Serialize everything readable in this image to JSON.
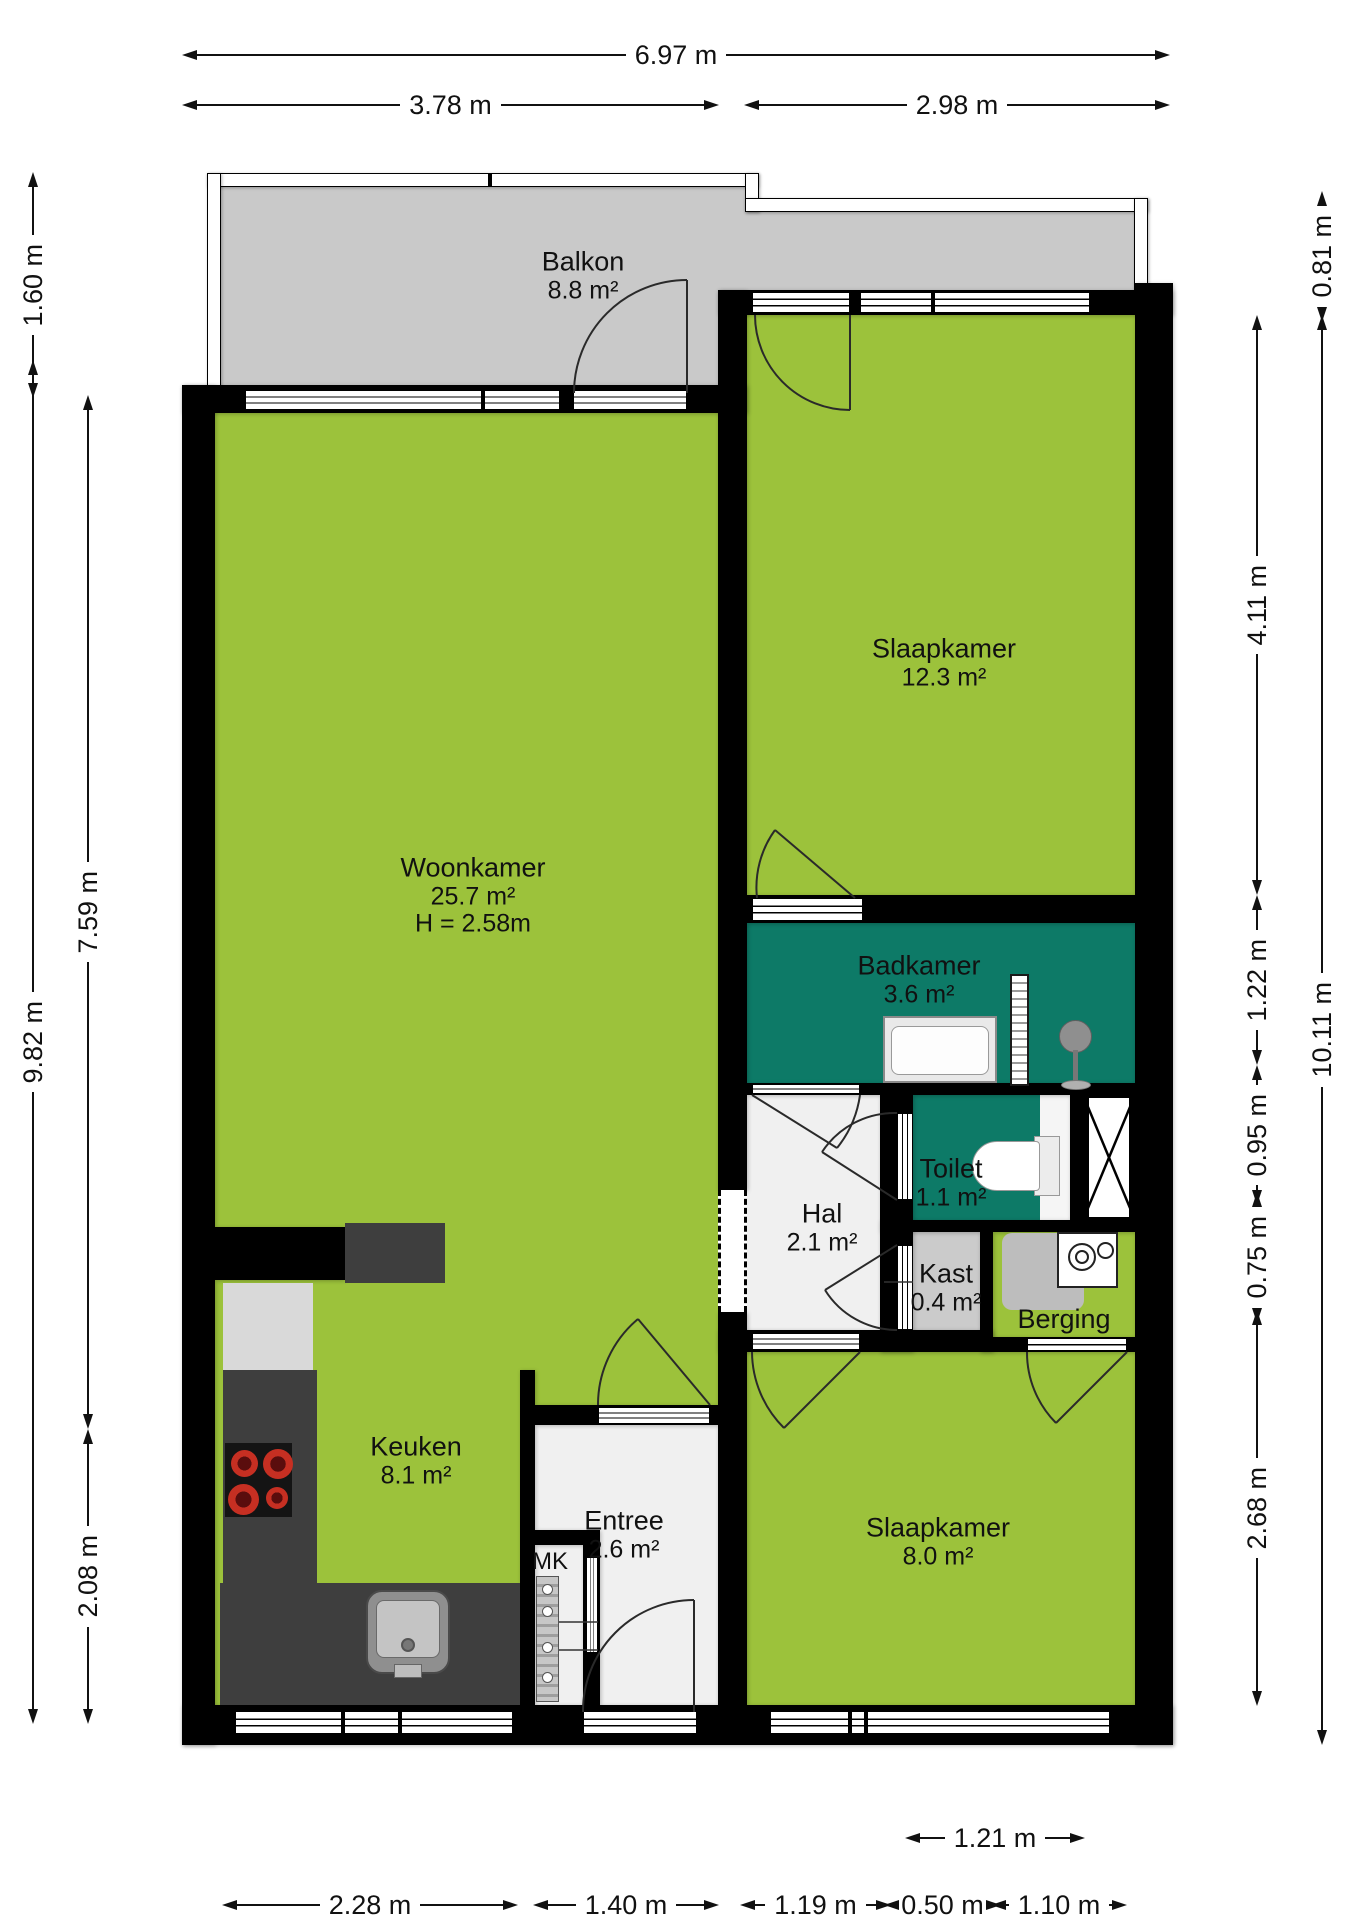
{
  "rooms": {
    "balkon": {
      "name": "Balkon",
      "area": "8.8 m²"
    },
    "woonkamer": {
      "name": "Woonkamer",
      "area": "25.7 m²",
      "ceiling_height": "H = 2.58m"
    },
    "slaapkamer_1": {
      "name": "Slaapkamer",
      "area": "12.3 m²"
    },
    "badkamer": {
      "name": "Badkamer",
      "area": "3.6 m²"
    },
    "toilet": {
      "name": "Toilet",
      "area": "1.1 m²"
    },
    "hal": {
      "name": "Hal",
      "area": "2.1 m²"
    },
    "kast": {
      "name": "Kast",
      "area": "0.4 m²"
    },
    "berging": {
      "name": "Berging"
    },
    "keuken": {
      "name": "Keuken",
      "area": "8.1 m²"
    },
    "entree": {
      "name": "Entree",
      "area": "2.6 m²"
    },
    "slaapkamer_2": {
      "name": "Slaapkamer",
      "area": "8.0 m²"
    },
    "meterkast": {
      "name": "MK"
    }
  },
  "dimensions": {
    "top_total": "6.97 m",
    "top_left": "3.78 m",
    "top_right": "2.98 m",
    "left_balcony": "1.60 m",
    "left_total": "9.82 m",
    "left_upper": "7.59 m",
    "left_lower": "2.08 m",
    "right_balcony": "0.81 m",
    "right_bedroom1": "4.11 m",
    "right_bathroom": "1.22 m",
    "right_toilet": "0.95 m",
    "right_storage": "0.75 m",
    "right_bedroom2": "2.68 m",
    "right_total": "10.11 m",
    "bottom_window": "1.21 m",
    "bottom_kitchen": "2.28 m",
    "bottom_entrance": "1.40 m",
    "bottom_hall": "1.19 m",
    "bottom_closet": "0.50 m",
    "bottom_storage": "1.10 m"
  },
  "colors": {
    "room_green": "#9cc23b",
    "wet_room_teal": "#0d7a67",
    "balcony_grey": "#c9c9c9",
    "counter_dark": "#3e3e3e",
    "wall_black": "#000000"
  }
}
